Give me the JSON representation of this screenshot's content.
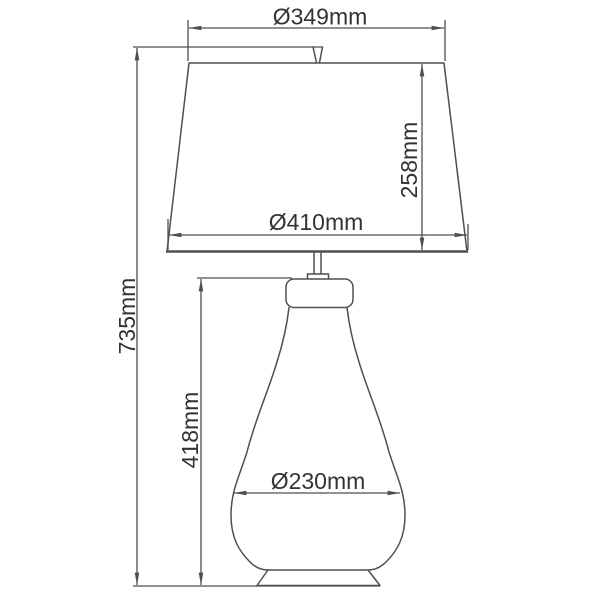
{
  "diagram": {
    "type": "technical-dimension-drawing",
    "subject": "table lamp with tapered shade and gourd-shaped body",
    "unit": "mm",
    "dimensions": {
      "shade_top_diameter": {
        "label": "Ø349mm",
        "value": 349,
        "unit": "mm"
      },
      "shade_height": {
        "label": "258mm",
        "value": 258,
        "unit": "mm"
      },
      "shade_bottom_diameter": {
        "label": "Ø410mm",
        "value": 410,
        "unit": "mm"
      },
      "total_height": {
        "label": "735mm",
        "value": 735,
        "unit": "mm"
      },
      "body_height": {
        "label": "418mm",
        "value": 418,
        "unit": "mm"
      },
      "body_diameter": {
        "label": "Ø230mm",
        "value": 230,
        "unit": "mm"
      }
    },
    "colors": {
      "line": "#4f4f4f",
      "text": "#333333",
      "background": "#ffffff"
    }
  }
}
